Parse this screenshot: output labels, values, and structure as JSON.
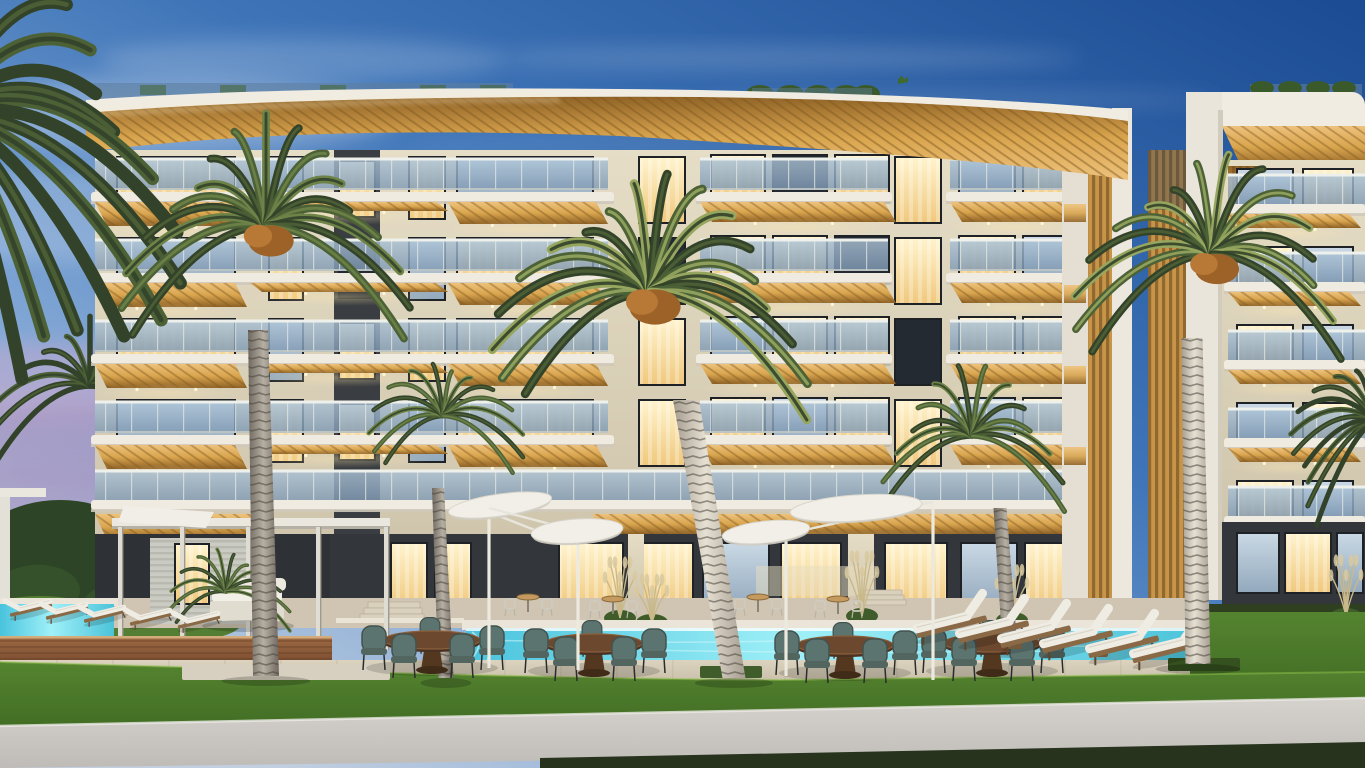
{
  "scene": {
    "width": 1365,
    "height": 768,
    "kind": "architectural-rendering",
    "time_of_day": "dusk",
    "subject": "modern-apartment-complex-with-pool-palms-and-lounge-terrace",
    "visible_text": ""
  },
  "palette": {
    "skyTopRight": "#1b4b93",
    "skyMid": "#3f75b8",
    "skyLow": "#84a9d6",
    "skyHorizon": "#c2cfe0",
    "dusk": "#c3a8ce",
    "duskDeep": "#9a85b4",
    "cloud": "#ffffff",
    "treeDark": "#2d4526",
    "treeMid": "#35512c",
    "bush": "#547e33",
    "fascia": "#f0ece1",
    "fasciaShade": "#d2ccbd",
    "wood1": "#8f6226",
    "wood2": "#d9a54e",
    "wood3": "#eec27c",
    "plank": "#7c561f",
    "facade1": "#e6ddc6",
    "facade2": "#cbc1a8",
    "facadeShade": "#b4aa90",
    "charcoal": "#45484d",
    "charcoalDark": "#33363a",
    "winWarm1": "#fff3cc",
    "winWarm2": "#f0c97e",
    "winCool1": "#c9d8e4",
    "winCool2": "#93a9bd",
    "winDark": "#242a31",
    "frame": "#1e2226",
    "glass1": "#a9c0d4",
    "glass2": "#7e98b2",
    "railWhite": "#eef0ec",
    "slab": "#efebe0",
    "slabShade": "#cfc9bb",
    "trunk1": "#6f6860",
    "trunk2": "#b6afa3",
    "trunkLit1": "#a59d90",
    "trunkLit2": "#e6e0d3",
    "ring": "#4a443b",
    "frondDark": "#33432a",
    "frondMid": "#4c6136",
    "frondLight": "#6d8348",
    "frondLit": "#96a65f",
    "dates1": "#9c6228",
    "dates2": "#b87936",
    "pool1": "#49c3dd",
    "pool2": "#9ff0f8",
    "pool3": "#4cc3da",
    "coping": "#eae5d8",
    "deck1": "#dcd3c0",
    "deck2": "#c6bca6",
    "grout": "#b3a98f",
    "woodDeck1": "#a06b45",
    "woodDeck2": "#7c4e30",
    "woodDeckLine": "#5e3a24",
    "terrace": "#cfc5b2",
    "grass1": "#558430",
    "grass2": "#3e6a22",
    "grassRim": "#8dc04a",
    "hedge": "#2e4020",
    "path1": "#d6d2ce",
    "path2": "#bfbbb7",
    "darkStrip": "#27331d",
    "chair1": "#5c7470",
    "chair2": "#42534f",
    "tableWood": "#6b482e",
    "tableWoodDark": "#4a3122",
    "cushion": "#efece3",
    "cushionShade": "#d9d5c9",
    "sunbedWood": "#8a6946",
    "white": "#f2efe8",
    "whiteShade": "#cfccc2",
    "stem": "#c9b98a",
    "plume": "#d8c9a0",
    "glow": "#ffe9b0"
  },
  "sky": {
    "clouds": [
      {
        "cx": 170,
        "cy": 115,
        "rx": 230,
        "ry": 38,
        "o": 0.26
      },
      {
        "cx": 90,
        "cy": 215,
        "rx": 190,
        "ry": 48,
        "o": 0.2
      },
      {
        "cx": 300,
        "cy": 60,
        "rx": 200,
        "ry": 22,
        "o": 0.18
      },
      {
        "cx": 780,
        "cy": 58,
        "rx": 300,
        "ry": 11,
        "o": 0.16
      },
      {
        "cx": 960,
        "cy": 100,
        "rx": 260,
        "ry": 9,
        "o": 0.12
      },
      {
        "cx": 620,
        "cy": 145,
        "rx": 210,
        "ry": 8,
        "o": 0.1
      }
    ],
    "dusk": [
      {
        "cx": 45,
        "cy": 385,
        "rx": 165,
        "ry": 42,
        "o": 0.55
      },
      {
        "cx": 95,
        "cy": 445,
        "rx": 215,
        "ry": 40,
        "o": 0.5
      },
      {
        "cx": 30,
        "cy": 505,
        "rx": 195,
        "ry": 34,
        "o": 0.45
      }
    ]
  },
  "backgroundTrees": {
    "dark": [
      [
        60,
        560,
        90,
        60
      ],
      [
        160,
        575,
        80,
        48
      ],
      [
        20,
        600,
        70,
        42
      ],
      [
        120,
        612,
        90,
        34
      ],
      [
        205,
        602,
        60,
        30
      ]
    ],
    "bushes": [
      [
        40,
        618,
        62,
        22
      ],
      [
        120,
        628,
        72,
        20
      ],
      [
        190,
        622,
        52,
        18
      ]
    ]
  },
  "mainBuilding": {
    "rows": {
      "y0": 160,
      "h": 81,
      "count": 4
    },
    "leftWing": {
      "x": 95,
      "x2": 590,
      "lit": [
        [
          "w",
          "c"
        ],
        [
          "c",
          "w"
        ],
        [
          "w",
          "w"
        ],
        [
          "c",
          "w"
        ]
      ],
      "col1Lit": [
        "c",
        "w",
        "c",
        "w"
      ],
      "col2Lit": [
        "w",
        "c",
        "w",
        "c"
      ],
      "recessLit": [
        "w",
        "d",
        "w",
        "w"
      ]
    },
    "rightWing": {
      "lit": [
        [
          "w",
          [
            "w",
            "d",
            "w"
          ],
          "w",
          [
            "c",
            "w"
          ]
        ],
        [
          "d",
          [
            "w",
            "w",
            "d"
          ],
          "w",
          [
            "w",
            "c"
          ]
        ],
        [
          "w",
          [
            "c",
            "w",
            "w"
          ],
          "d",
          [
            "w",
            "w"
          ]
        ],
        [
          "w",
          [
            "w",
            "c",
            "w"
          ],
          "w",
          [
            "c",
            "w"
          ]
        ]
      ]
    },
    "groundPanels": [
      {
        "x": 392,
        "w": 34,
        "t": "w"
      },
      {
        "x": 436,
        "w": 34,
        "t": "w"
      },
      {
        "x": 560,
        "w": 62,
        "t": "w"
      },
      {
        "x": 640,
        "w": 52,
        "t": "w"
      },
      {
        "x": 704,
        "w": 64,
        "t": "c"
      },
      {
        "x": 782,
        "w": 58,
        "t": "w"
      },
      {
        "x": 886,
        "w": 60,
        "t": "w"
      },
      {
        "x": 962,
        "w": 54,
        "t": "c"
      },
      {
        "x": 1026,
        "w": 48,
        "t": "w"
      }
    ],
    "pillars": [
      {
        "x": 628,
        "w": 16
      },
      {
        "x": 848,
        "w": 26
      }
    ]
  },
  "rightBuilding": {
    "rows": {
      "y0": 176,
      "h": 78,
      "count": 5
    },
    "rowLit": [
      "c",
      "w",
      "w",
      "c",
      "w"
    ],
    "groundPanels": [
      {
        "x": 1238,
        "w": 40,
        "t": "c"
      },
      {
        "x": 1286,
        "w": 44,
        "t": "w"
      },
      {
        "x": 1338,
        "w": 24,
        "t": "c"
      }
    ]
  },
  "grassPath": {
    "grass": "M0,662 C300,670 560,679 780,680 L1365,672 L1365,716 L0,738 Z",
    "path": "M0,726 L1365,698 L1365,750 L0,768 Z",
    "dark": "M540,758 L1365,742 L1365,768 L540,768 Z"
  },
  "furniture": {
    "diningSets": [
      {
        "x": 432,
        "y": 640
      },
      {
        "x": 594,
        "y": 643
      },
      {
        "x": 845,
        "y": 645
      },
      {
        "x": 992,
        "y": 643
      }
    ],
    "bistroSets": [
      {
        "x": 528,
        "y": 612
      },
      {
        "x": 613,
        "y": 614
      },
      {
        "x": 758,
        "y": 612
      },
      {
        "x": 838,
        "y": 614
      }
    ],
    "sunbedsRight": [
      {
        "x": 950,
        "y": 620
      },
      {
        "x": 992,
        "y": 625
      },
      {
        "x": 1034,
        "y": 630
      },
      {
        "x": 1076,
        "y": 635
      },
      {
        "x": 1122,
        "y": 640
      },
      {
        "x": 1166,
        "y": 645
      }
    ],
    "sideTables": [
      {
        "x": 1014,
        "y": 644
      },
      {
        "x": 1100,
        "y": 652
      }
    ],
    "sunbedsLeft": [
      {
        "x": 30,
        "y": 606
      },
      {
        "x": 66,
        "y": 609
      },
      {
        "x": 104,
        "y": 612
      },
      {
        "x": 150,
        "y": 615
      },
      {
        "x": 198,
        "y": 618
      }
    ],
    "umbrellas": [
      {
        "cx": 500,
        "cy": 505,
        "rx": 52,
        "ry": 11,
        "rot": -8,
        "pole": [
          489,
          508,
          489,
          668
        ],
        "arm": [
          489,
          512,
          560,
          540
        ]
      },
      {
        "cx": 577,
        "cy": 531,
        "rx": 46,
        "ry": 12,
        "rot": -4,
        "pole": [
          578,
          533,
          578,
          670
        ],
        "arm": [
          489,
          508,
          577,
          531
        ]
      },
      {
        "cx": 766,
        "cy": 532,
        "rx": 44,
        "ry": 11,
        "rot": -6,
        "pole": [
          786,
          534,
          786,
          676
        ],
        "arm": [
          933,
          502,
          786,
          534
        ]
      },
      {
        "cx": 856,
        "cy": 508,
        "rx": 66,
        "ry": 13,
        "rot": -4,
        "pole": [
          933,
          502,
          933,
          680
        ],
        "arm": [
          933,
          502,
          856,
          510
        ]
      }
    ]
  },
  "pampas": [
    {
      "x": 620,
      "y": 618,
      "h": 58
    },
    {
      "x": 652,
      "y": 622,
      "h": 44
    },
    {
      "x": 862,
      "y": 616,
      "h": 62
    },
    {
      "x": 1012,
      "y": 620,
      "h": 52
    },
    {
      "x": 1346,
      "y": 616,
      "h": 58
    }
  ],
  "palms": [
    {
      "name": "palm-top-left",
      "cx": -55,
      "cy": 115,
      "r": 235,
      "fronds": 14,
      "arc": [
        -70,
        80
      ],
      "tone": "dark",
      "layer": "front"
    },
    {
      "name": "palm-left-small",
      "cx": 90,
      "cy": 386,
      "r": 100,
      "fronds": 13,
      "tone": "dark",
      "layer": "bg",
      "trunk": {
        "x": 104,
        "y": 452,
        "x2": 112,
        "y2": 602,
        "w1": 9,
        "w2": 12
      }
    },
    {
      "name": "palm-left-large",
      "cx": 266,
      "cy": 226,
      "r": 142,
      "fronds": 17,
      "dates": true,
      "layer": "front",
      "trunk": {
        "x": 258,
        "y": 330,
        "x2": 266,
        "y2": 676,
        "w1": 20,
        "w2": 26
      }
    },
    {
      "name": "palm-cabana",
      "cx": 226,
      "cy": 592,
      "r": 64,
      "fronds": 12,
      "arc": [
        -185,
        5
      ],
      "tone": "mid",
      "layer": "mid"
    },
    {
      "name": "palm-mid-left",
      "cx": 443,
      "cy": 416,
      "r": 82,
      "fronds": 14,
      "layer": "mid",
      "trunk": {
        "x": 438,
        "y": 488,
        "x2": 446,
        "y2": 678,
        "w1": 12,
        "w2": 15
      }
    },
    {
      "name": "palm-center-large",
      "cx": 650,
      "cy": 292,
      "r": 160,
      "fronds": 18,
      "dates": true,
      "lit": true,
      "layer": "front",
      "trunk": {
        "x": 686,
        "y": 400,
        "x2": 734,
        "y2": 678,
        "w1": 26,
        "w2": 23,
        "lit": true
      }
    },
    {
      "name": "palm-mid-right",
      "cx": 972,
      "cy": 436,
      "r": 95,
      "fronds": 14,
      "layer": "mid",
      "trunk": {
        "x": 1000,
        "y": 508,
        "x2": 1010,
        "y2": 648,
        "w1": 13,
        "w2": 15
      }
    },
    {
      "name": "palm-right-large",
      "cx": 1212,
      "cy": 254,
      "r": 138,
      "fronds": 16,
      "dates": true,
      "lit": true,
      "layer": "front",
      "trunk": {
        "x": 1192,
        "y": 338,
        "x2": 1198,
        "y2": 664,
        "w1": 21,
        "w2": 25,
        "lit": true
      }
    },
    {
      "name": "palm-right-edge",
      "cx": 1374,
      "cy": 420,
      "r": 90,
      "fronds": 11,
      "arc": [
        -230,
        -90
      ],
      "tone": "dark",
      "layer": "front"
    }
  ]
}
